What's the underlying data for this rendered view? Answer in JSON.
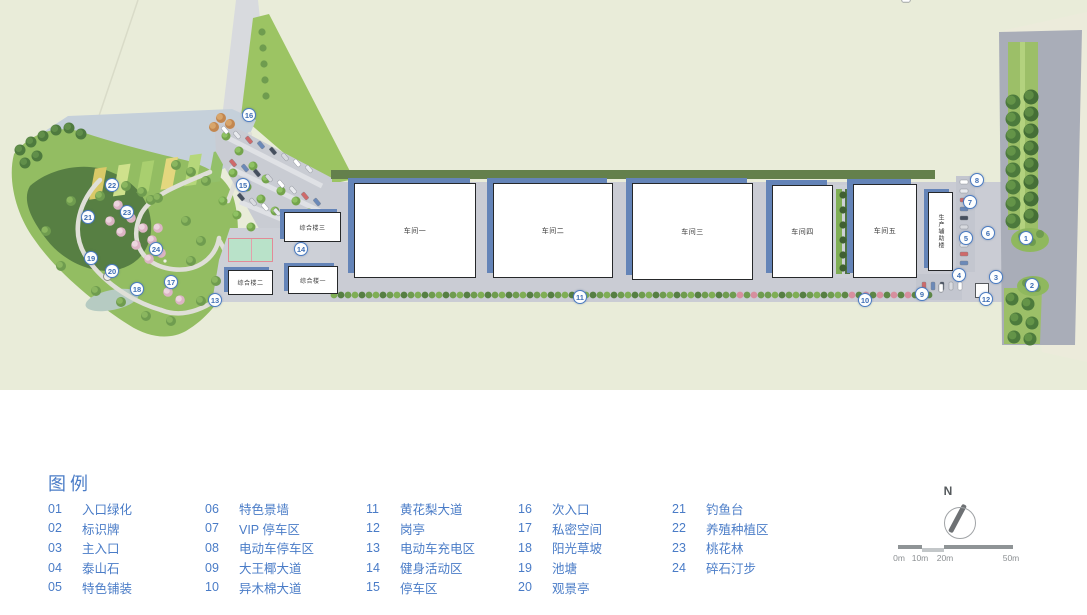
{
  "legend": {
    "title": "图例",
    "text_color": "#4a7cc7",
    "items": [
      {
        "num": "01",
        "label": "入口绿化"
      },
      {
        "num": "02",
        "label": "标识牌"
      },
      {
        "num": "03",
        "label": "主入口"
      },
      {
        "num": "04",
        "label": "泰山石"
      },
      {
        "num": "05",
        "label": "特色铺装"
      },
      {
        "num": "06",
        "label": "特色景墙"
      },
      {
        "num": "07",
        "label": "VIP 停车区"
      },
      {
        "num": "08",
        "label": "电动车停车区"
      },
      {
        "num": "09",
        "label": "大王椰大道"
      },
      {
        "num": "10",
        "label": "异木棉大道"
      },
      {
        "num": "11",
        "label": "黄花梨大道"
      },
      {
        "num": "12",
        "label": "岗亭"
      },
      {
        "num": "13",
        "label": "电动车充电区"
      },
      {
        "num": "14",
        "label": "健身活动区"
      },
      {
        "num": "15",
        "label": "停车区"
      },
      {
        "num": "16",
        "label": "次入口"
      },
      {
        "num": "17",
        "label": "私密空间"
      },
      {
        "num": "18",
        "label": "阳光草坡"
      },
      {
        "num": "19",
        "label": "池塘"
      },
      {
        "num": "20",
        "label": "观景亭"
      },
      {
        "num": "21",
        "label": "钓鱼台"
      },
      {
        "num": "22",
        "label": "养殖种植区"
      },
      {
        "num": "23",
        "label": "桃花林"
      },
      {
        "num": "24",
        "label": "碎石汀步"
      }
    ]
  },
  "plan": {
    "buildings": {
      "workshop1": "车间一",
      "workshop2": "车间二",
      "workshop3": "车间三",
      "workshop4": "车间四",
      "workshop5": "车间五",
      "complex1": "综合楼一",
      "complex2": "综合楼二",
      "complex3": "综合楼三",
      "aux": "生产辅助楼"
    },
    "markers": [
      {
        "num": "1",
        "x": 1026,
        "y": 238
      },
      {
        "num": "2",
        "x": 1032,
        "y": 285
      },
      {
        "num": "3",
        "x": 996,
        "y": 277
      },
      {
        "num": "4",
        "x": 959,
        "y": 275
      },
      {
        "num": "5",
        "x": 966,
        "y": 238
      },
      {
        "num": "6",
        "x": 988,
        "y": 233
      },
      {
        "num": "7",
        "x": 970,
        "y": 202
      },
      {
        "num": "8",
        "x": 977,
        "y": 180
      },
      {
        "num": "9",
        "x": 922,
        "y": 294
      },
      {
        "num": "10",
        "x": 865,
        "y": 300
      },
      {
        "num": "11",
        "x": 580,
        "y": 297
      },
      {
        "num": "12",
        "x": 986,
        "y": 299
      },
      {
        "num": "13",
        "x": 215,
        "y": 300
      },
      {
        "num": "14",
        "x": 301,
        "y": 249
      },
      {
        "num": "15",
        "x": 243,
        "y": 185
      },
      {
        "num": "16",
        "x": 249,
        "y": 115
      },
      {
        "num": "17",
        "x": 171,
        "y": 282
      },
      {
        "num": "18",
        "x": 137,
        "y": 289
      },
      {
        "num": "19",
        "x": 91,
        "y": 258
      },
      {
        "num": "20",
        "x": 112,
        "y": 271
      },
      {
        "num": "21",
        "x": 88,
        "y": 217
      },
      {
        "num": "22",
        "x": 112,
        "y": 185
      },
      {
        "num": "23",
        "x": 127,
        "y": 212
      },
      {
        "num": "24",
        "x": 156,
        "y": 249
      }
    ],
    "colors": {
      "background": "#e9ecd9",
      "water_gray": "#c5d0da",
      "lawn": "#93bd62",
      "dark_lawn": "#577f43",
      "road": "#caccd4",
      "outer_road": "#a9adb8",
      "building_shadow": "#6484b8",
      "marker_blue": "#4b7cc2",
      "court_green": "#b9e2c9",
      "court_border": "#e28a97"
    }
  },
  "compass": {
    "north_label": "N"
  },
  "scale_bar": {
    "labels": [
      "0m",
      "10m",
      "20m",
      "50m"
    ]
  }
}
